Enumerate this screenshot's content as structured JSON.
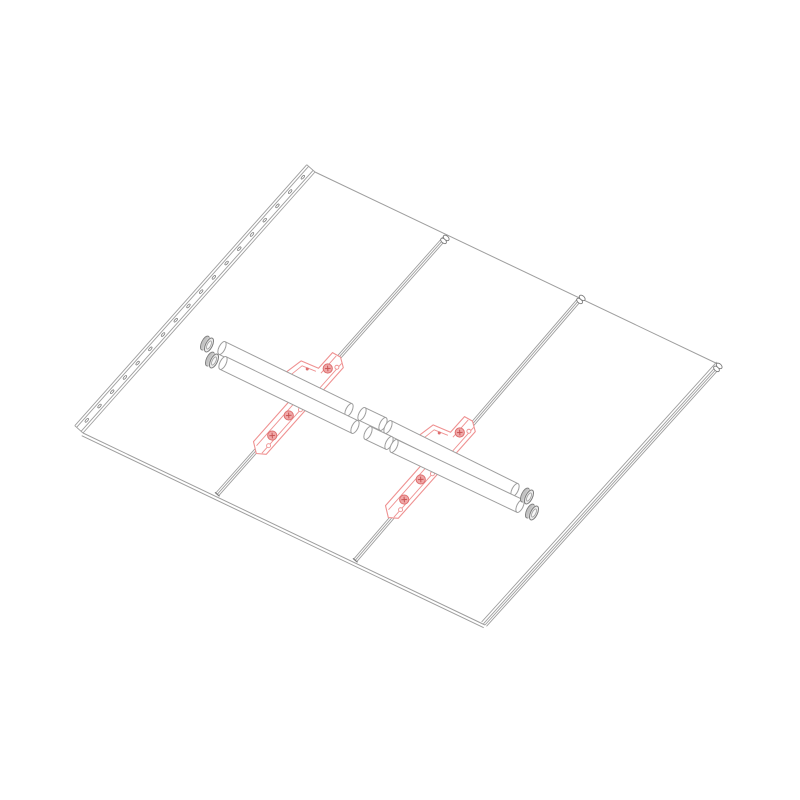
{
  "document": {
    "kind": "technical-assembly-drawing",
    "view": "isometric-exploded",
    "visible_text": "",
    "parts": [
      {
        "name": "roof-panel-array",
        "style": "gray-outline"
      },
      {
        "name": "perforated-edge-rail",
        "style": "gray-outline"
      },
      {
        "name": "standing-seam-rib",
        "count": 3,
        "style": "gray-outline"
      },
      {
        "name": "seam-mounting-bracket",
        "count": 2,
        "style": "red-highlight"
      },
      {
        "name": "support-pipe",
        "count": 2,
        "style": "gray-outline"
      },
      {
        "name": "pipe-coupler",
        "count": 2,
        "style": "gray-outline"
      },
      {
        "name": "pipe-end-cap",
        "count": 4,
        "style": "gray-shaded"
      }
    ]
  },
  "drawing": {
    "canvas": {
      "width": 800,
      "height": 800,
      "background": "#ffffff"
    },
    "colors": {
      "gray": "#9e9e9e",
      "gray_dark": "#7d7d7d",
      "red": "#ef9191",
      "red_dark": "#dd6f6f",
      "red_x": "#c85555",
      "bolt_fill": "#f0a8a8",
      "white": "#ffffff",
      "cap_body": "#cfcfcf",
      "cap_back": "#c2c2c2",
      "cap_face": "#ececec",
      "cap_inner": "#f7f7f7"
    },
    "panel": {
      "corners": {
        "top": [
          315,
          172
        ],
        "right": [
          720,
          365
        ],
        "bottom": [
          485,
          625
        ],
        "left": [
          83,
          433
        ]
      },
      "bottom_thickness_offset": 3
    },
    "rail": {
      "from": [
        315,
        172
      ],
      "to": [
        83,
        433
      ],
      "offsets": [
        0,
        2.5,
        8.5,
        11
      ],
      "hole_offset": 5.6,
      "hole_count": 18,
      "hole_margin": 12,
      "hole_rx": 2.3,
      "hole_ry": 1.0
    },
    "seams": [
      {
        "name": "seam-rib-1",
        "from": [
          447,
          237
        ],
        "to": [
          218,
          495
        ],
        "offsets": [
          -1,
          1,
          3
        ],
        "cap": true,
        "foot": true
      },
      {
        "name": "seam-rib-2",
        "from": [
          583,
          297
        ],
        "to": [
          356,
          561
        ],
        "offsets": [
          -1,
          1,
          3
        ],
        "cap": true,
        "foot": true
      },
      {
        "name": "seam-rib-right-edge",
        "from": [
          720,
          365
        ],
        "to": [
          485,
          625
        ],
        "offsets": [
          -2,
          0,
          2,
          4.5
        ],
        "cap": true,
        "foot": false
      }
    ],
    "pipes": [
      {
        "name": "support-pipe-upper",
        "r": 7,
        "angle": 25.86,
        "segments": [
          [
            [
              222,
              348
            ],
            [
              349,
              410
            ]
          ],
          [
            [
              362,
              414
            ],
            [
              383,
              424
            ]
          ],
          [
            [
              388,
              427
            ],
            [
              515,
              490
            ]
          ]
        ]
      },
      {
        "name": "support-pipe-lower",
        "r": 7,
        "angle": 25.86,
        "segments": [
          [
            [
              223,
              363
            ],
            [
              355,
              427
            ]
          ],
          [
            [
              368,
              433
            ],
            [
              389,
              443
            ]
          ],
          [
            [
              394,
              446
            ],
            [
              520,
              506
            ]
          ]
        ]
      }
    ],
    "end_caps": {
      "angle": 25.86,
      "rx": 3.4,
      "ry": 7.6,
      "depth": 4.5,
      "centers": [
        [
          209,
          345
        ],
        [
          214,
          361
        ],
        [
          529,
          497
        ],
        [
          534,
          513
        ]
      ]
    },
    "brackets": {
      "centers": [
        [
          306,
          396
        ],
        [
          438,
          460
        ]
      ],
      "axis": [
        -0.664,
        0.748
      ],
      "outline": [
        [
          -50,
          -9
        ],
        [
          -29,
          -9
        ],
        [
          -23,
          -27
        ],
        [
          -3,
          -31
        ],
        [
          9,
          -27
        ],
        [
          15,
          -9
        ],
        [
          69,
          -9
        ],
        [
          76,
          1
        ],
        [
          70,
          9
        ],
        [
          -46,
          9
        ],
        [
          -52,
          0
        ]
      ],
      "inner_lines": [
        [
          [
            -50,
            -4
          ],
          [
            -27,
            -4
          ]
        ],
        [
          [
            13,
            -4
          ],
          [
            70,
            -4
          ]
        ],
        [
          [
            -48,
            5
          ],
          [
            72,
            5
          ]
        ]
      ],
      "hump_inner": [
        [
          -25,
          -9
        ],
        [
          -20,
          -23
        ],
        [
          -2,
          -26
        ],
        [
          7,
          -23
        ],
        [
          12,
          -9
        ]
      ],
      "bolts": [
        [
          -35,
          -2
        ],
        [
          26,
          0
        ],
        [
          52,
          1
        ]
      ],
      "bolt_r": 4.6,
      "holes": [
        [
          -42,
          4
        ],
        [
          14,
          5
        ],
        [
          62,
          5
        ]
      ],
      "hole_r": 2,
      "rivets": [
        [
          -21,
          -17
        ],
        [
          6,
          -17
        ]
      ],
      "rivet_r": 1.5
    }
  }
}
